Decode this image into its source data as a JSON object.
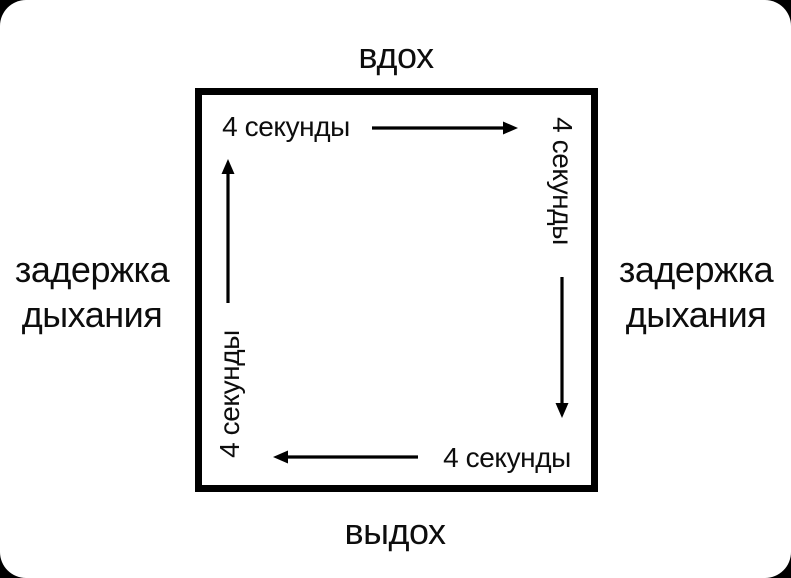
{
  "diagram": {
    "kind": "box-breathing-cycle",
    "colors": {
      "page_background": "#000000",
      "card_background": "#ffffff",
      "line": "#000000",
      "text": "#0d0d0d"
    },
    "labels": {
      "top": "вдох",
      "bottom": "выдох",
      "left": [
        "задержка",
        "дыхания"
      ],
      "right": [
        "задержка",
        "дыхания"
      ]
    },
    "cycle": {
      "top": {
        "duration": "4 секунды",
        "arrow_direction": "right"
      },
      "right": {
        "duration": "4 секунды",
        "arrow_direction": "down"
      },
      "bottom": {
        "duration": "4 секунды",
        "arrow_direction": "left"
      },
      "left": {
        "duration": "4 секунды",
        "arrow_direction": "up"
      }
    }
  }
}
